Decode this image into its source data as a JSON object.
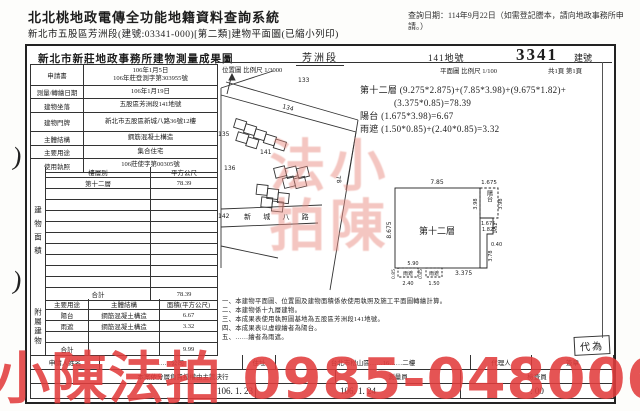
{
  "header": {
    "system_title": "北北桃地政電傳全功能地籍資料查詢系統",
    "query_date": "查詢日期：114年9月22日（如需登記謄本，請向地政事務所申請。）",
    "subtitle": "新北市五股區芳洲段(建號:03341-000)[第二類]建物平面圖(已縮小列印)"
  },
  "doc": {
    "office_title": "新北市新莊地政事務所建物測量成果圖",
    "section": "芳洲段",
    "parcel_no": "141地號",
    "building_no": "3341",
    "building_no_label": "建號",
    "plan_scale": "平面圖 比例尺 1/100",
    "page_info": "共1頁 第1頁",
    "map_scale": "位置圖 比例尺 1/3000"
  },
  "info_table": {
    "rows": [
      {
        "label": "申請書",
        "value": "106年1月5日",
        "value2": "106年莊登測字第303955號"
      },
      {
        "label": "測量/轉繪日期",
        "value": "106年1月19日",
        "value2": ""
      },
      {
        "label": "建物坐落",
        "value": "五股區芳洲段141地號",
        "value2": ""
      },
      {
        "label": "建物門牌",
        "value": "新北市五股區新城八路36號12樓",
        "value2": ""
      },
      {
        "label": "主體結構",
        "value": "鋼筋混凝土構造",
        "value2": ""
      },
      {
        "label": "主要用途",
        "value": "集合住宅",
        "value2": ""
      },
      {
        "label": "使用執照",
        "value": "106莊使字第00305號",
        "value2": ""
      }
    ]
  },
  "floor_table": {
    "side_label": "建物面積",
    "col_level": "樓層別",
    "col_area": "平方公尺",
    "rows": [
      {
        "level": "第十二層",
        "area": "78.39"
      }
    ],
    "total_label": "合計",
    "total": "78.39"
  },
  "annex_table": {
    "side_label": "附屬建物",
    "col_use": "主要用途",
    "col_struct": "主體結構",
    "col_area": "面積(平方公尺)",
    "rows": [
      {
        "use": "陽台",
        "struct": "鋼筋混凝土構造",
        "area": "6.67"
      },
      {
        "use": "雨遮",
        "struct": "鋼筋混凝土構造",
        "area": "3.32"
      }
    ],
    "total_label": "合計",
    "total": "9.99"
  },
  "calc": {
    "line1": "第十二層 (9.275*2.875)+(7.85*3.98)+(9.675*1.82)+",
    "line2": "(3.375*0.85)=78.39",
    "line3": "陽台 (1.675*3.98)=6.67",
    "line4": "雨遮 (1.50*0.85)+(2.40*0.85)=3.32"
  },
  "plan": {
    "room_label": "第十二層",
    "balcony_label": "陽台",
    "canopy1_label": "雨遮",
    "canopy2_label": "雨遮",
    "dim_top": "7.85",
    "dim_top_right": "1.675",
    "dim_left": "8.675",
    "dim_balcony_left": "3.98",
    "dim_balcony_right": "3.98",
    "dim_under_balcony1": "1.675",
    "dim_under_balcony2": "1.825",
    "dim_right1": "1.52",
    "dim_right2": "0.40",
    "dim_right3": "3.78",
    "dim_590": "5.90",
    "dim_240": "2.40",
    "dim_150": "1.50",
    "dim_3375": "3.375",
    "dim_085a": "0.85",
    "dim_085b": "0.85"
  },
  "map": {
    "labels": {
      "p133": "133",
      "p134": "134",
      "p135": "135",
      "p136": "136",
      "p141": "141",
      "p142": "142",
      "p78": "78"
    },
    "street": "新 城 八 路"
  },
  "notes": {
    "n1": "一、本建物平面圖、位置圖及建物面積係依使用執照及施工平面圖轉繪計算。",
    "n2": "二、本建物係十九層建物。",
    "n3": "三、本成果表使用執照圖基地為五股區芳洲段141地號。",
    "n4": "四、本成果表以虛線繪者為陽台。",
    "n5": "五、……繪者為雨遮。"
  },
  "footer": {
    "row1": {
      "c1": "申請人姓名",
      "c2": "……公司",
      "c3": "住址",
      "c4": "台北市松山區……16……二樓",
      "c5": "代理人",
      "c6": "簽章"
    },
    "row2": {
      "c1": "本案依分層負責授權由主管決行",
      "c2": "測量員",
      "c3": "檢查員"
    },
    "row3": {
      "date1": "106. 1. 23",
      "date2": "106. 1. 24",
      "time": ": 00"
    }
  },
  "stamp": {
    "text": "代為"
  },
  "watermark": {
    "main": "小陳法拍 0985-048006",
    "seal": "小陳法拍",
    "color": "#e23d3d"
  }
}
